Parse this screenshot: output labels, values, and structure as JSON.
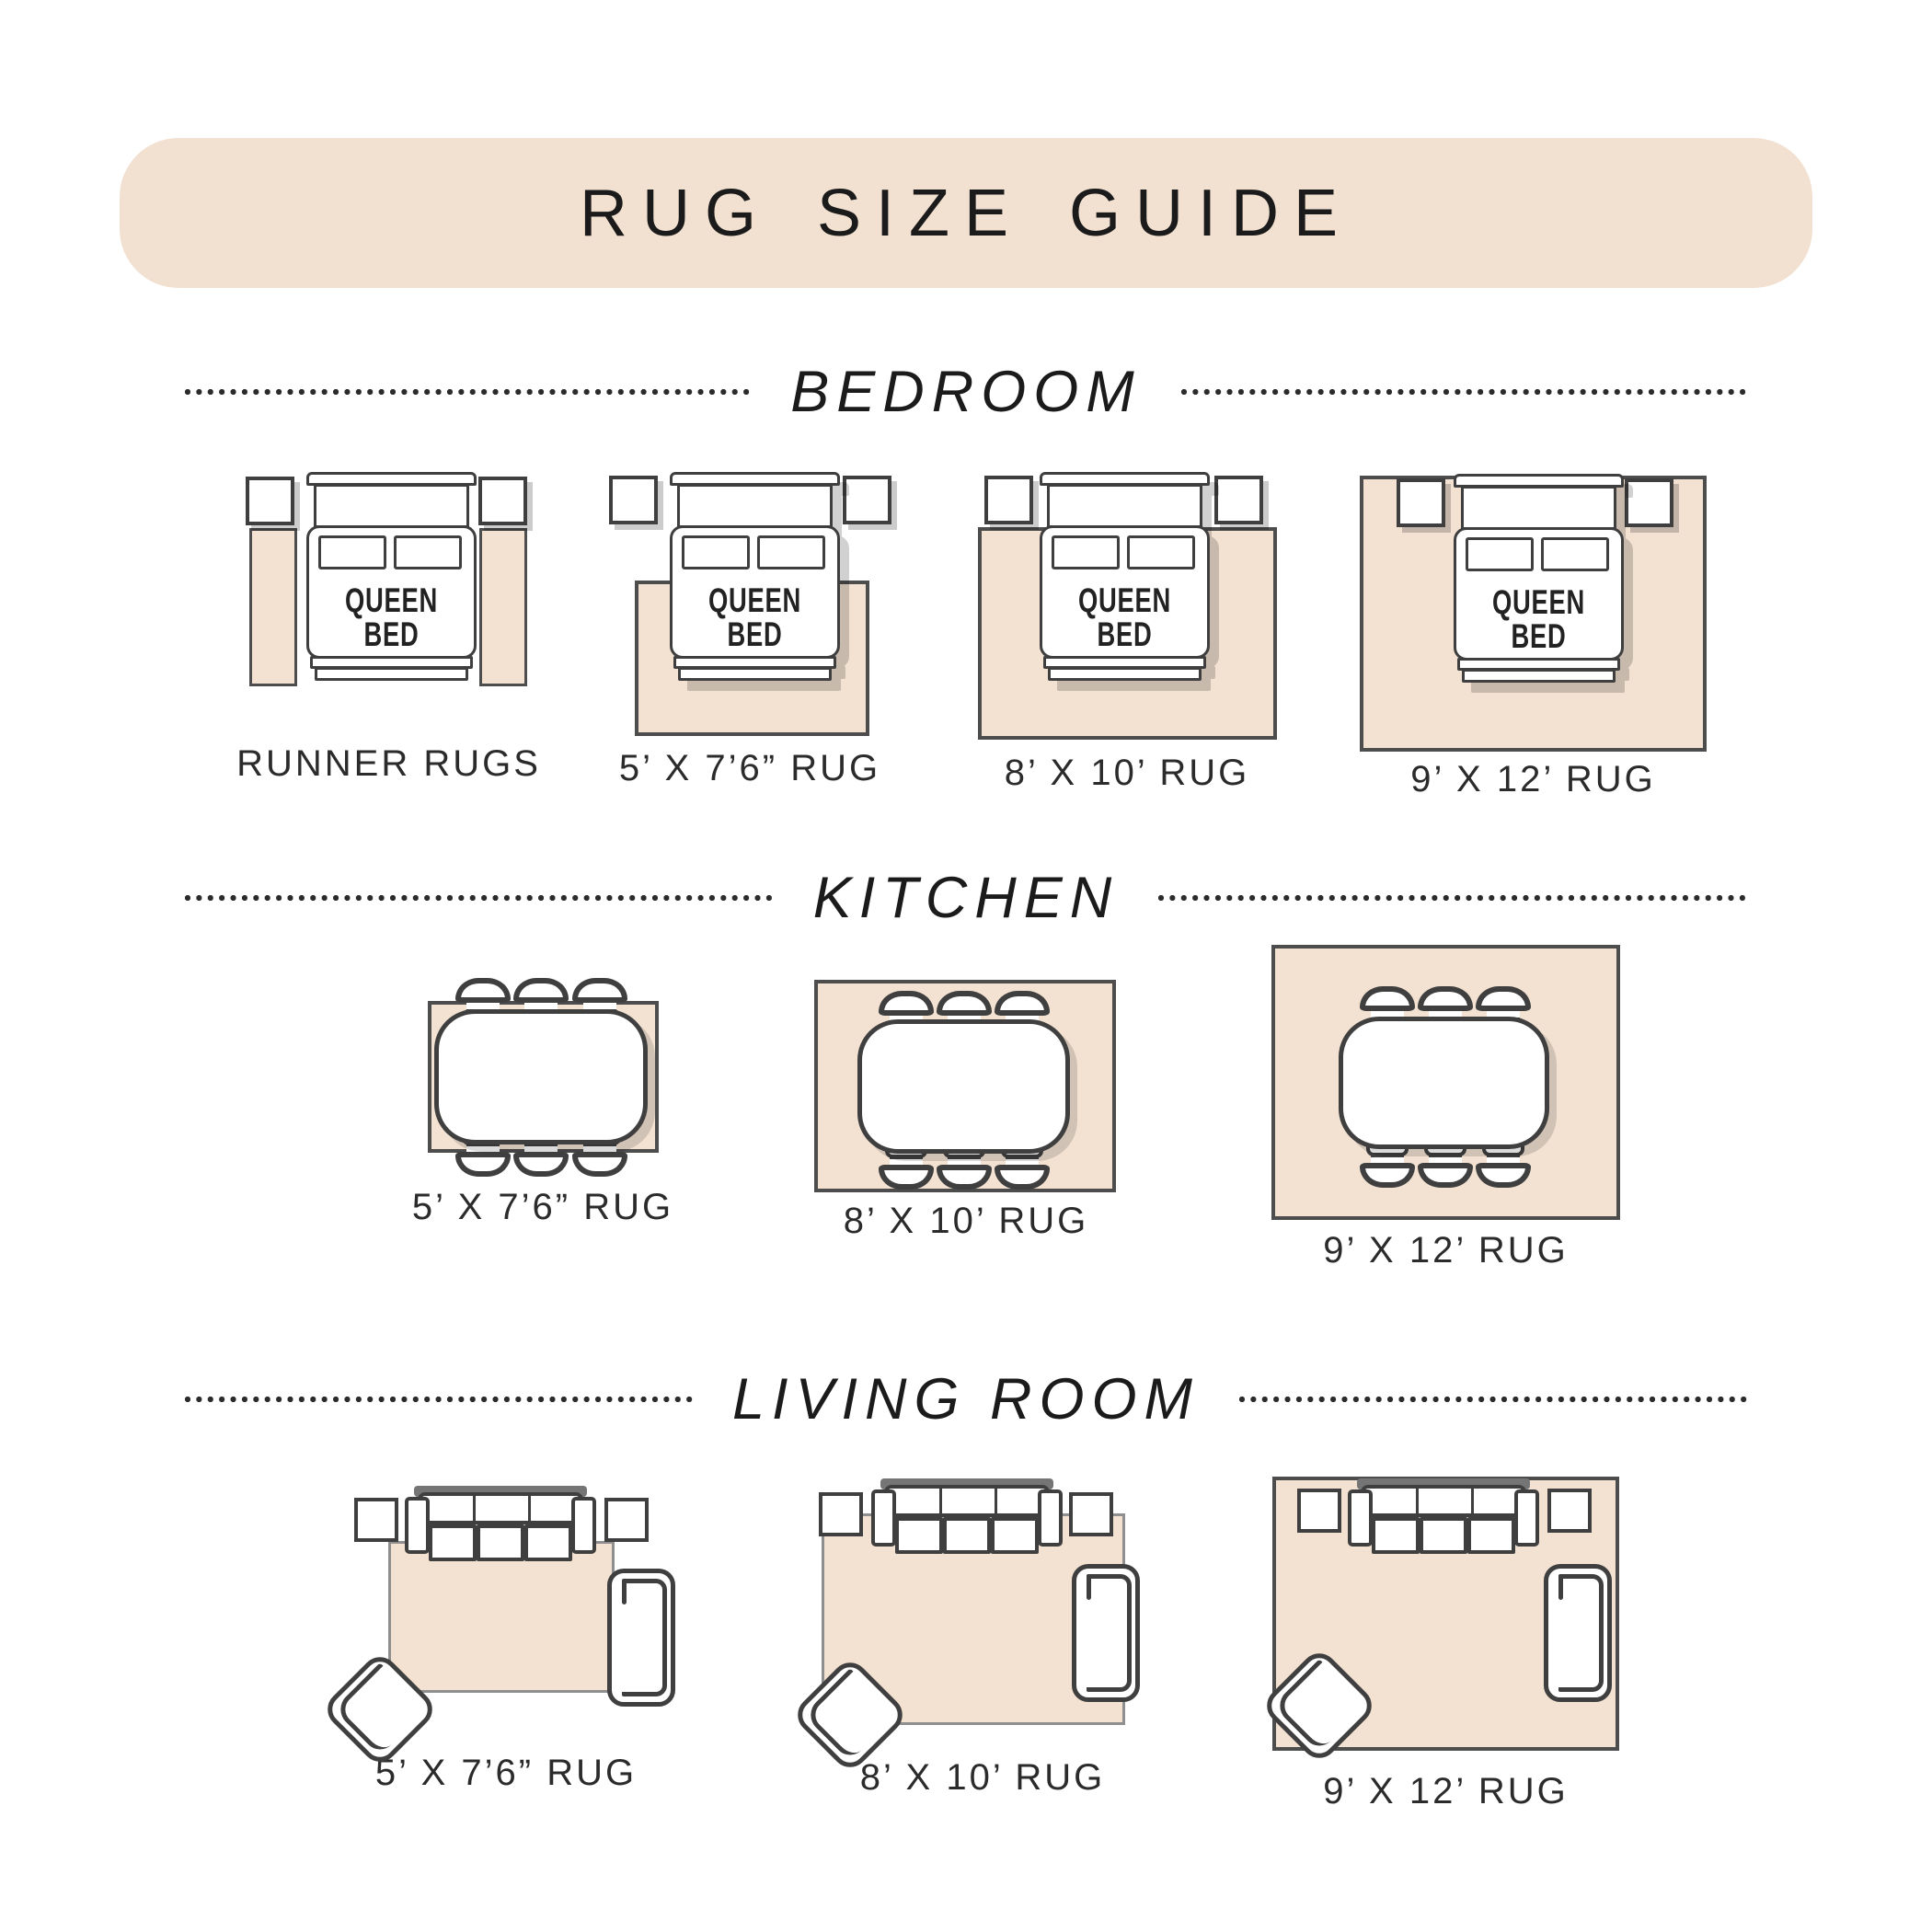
{
  "title": "RUG SIZE GUIDE",
  "colors": {
    "banner_bg": "#f2e0d0",
    "rug_fill": "#f3e2d2",
    "outline": "#3f3f3f",
    "rug_border": "#4d4d4d",
    "soft_border": "#8f8f8f",
    "heading_text": "#1b1b1b",
    "label_text": "#2b2b2b"
  },
  "bedroom": {
    "heading": "BEDROOM",
    "bed_label": "QUEEN BED",
    "diagrams": [
      {
        "label": "RUNNER RUGS"
      },
      {
        "label": "5’ X 7’6” RUG"
      },
      {
        "label": "8’ X 10’ RUG"
      },
      {
        "label": "9’ X 12’ RUG"
      }
    ]
  },
  "kitchen": {
    "heading": "KITCHEN",
    "diagrams": [
      {
        "label": "5’ X 7’6” RUG"
      },
      {
        "label": "8’ X 10’ RUG"
      },
      {
        "label": "9’ X 12’ RUG"
      }
    ]
  },
  "living_room": {
    "heading": "LIVING ROOM",
    "diagrams": [
      {
        "label": "5’ X 7’6” RUG"
      },
      {
        "label": "8’ X 10’ RUG"
      },
      {
        "label": "9’ X 12’ RUG"
      }
    ]
  }
}
